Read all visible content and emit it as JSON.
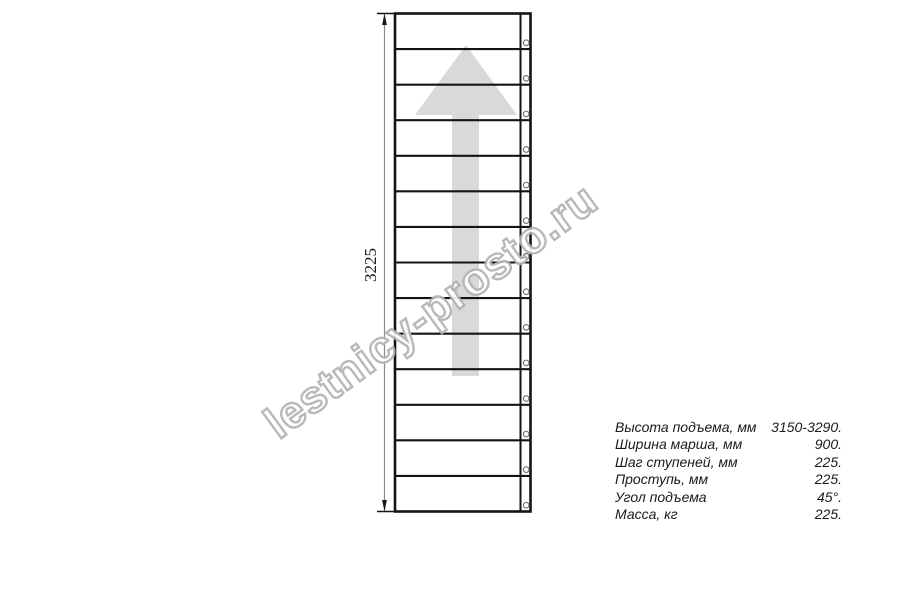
{
  "drawing": {
    "dimension_label": "3225",
    "steps": 14,
    "arrow_color": "#d9d9d9",
    "line_color": "#141414",
    "dim_line_color": "#8a8a8a",
    "circle_color": "#6e6e6e"
  },
  "watermark": {
    "text": "lestnicy-prosto.ru",
    "outline_color": "#b4b4b4"
  },
  "specs": {
    "rows": [
      {
        "label": "Высота подъема, мм",
        "value": "3150-3290."
      },
      {
        "label": "Ширина марша, мм",
        "value": "900."
      },
      {
        "label": "Шаг ступеней, мм",
        "value": "225."
      },
      {
        "label": "Проступь, мм",
        "value": "225."
      },
      {
        "label": "Угол подъема",
        "value": "45°."
      },
      {
        "label": "Масса, кг",
        "value": "225."
      }
    ]
  }
}
